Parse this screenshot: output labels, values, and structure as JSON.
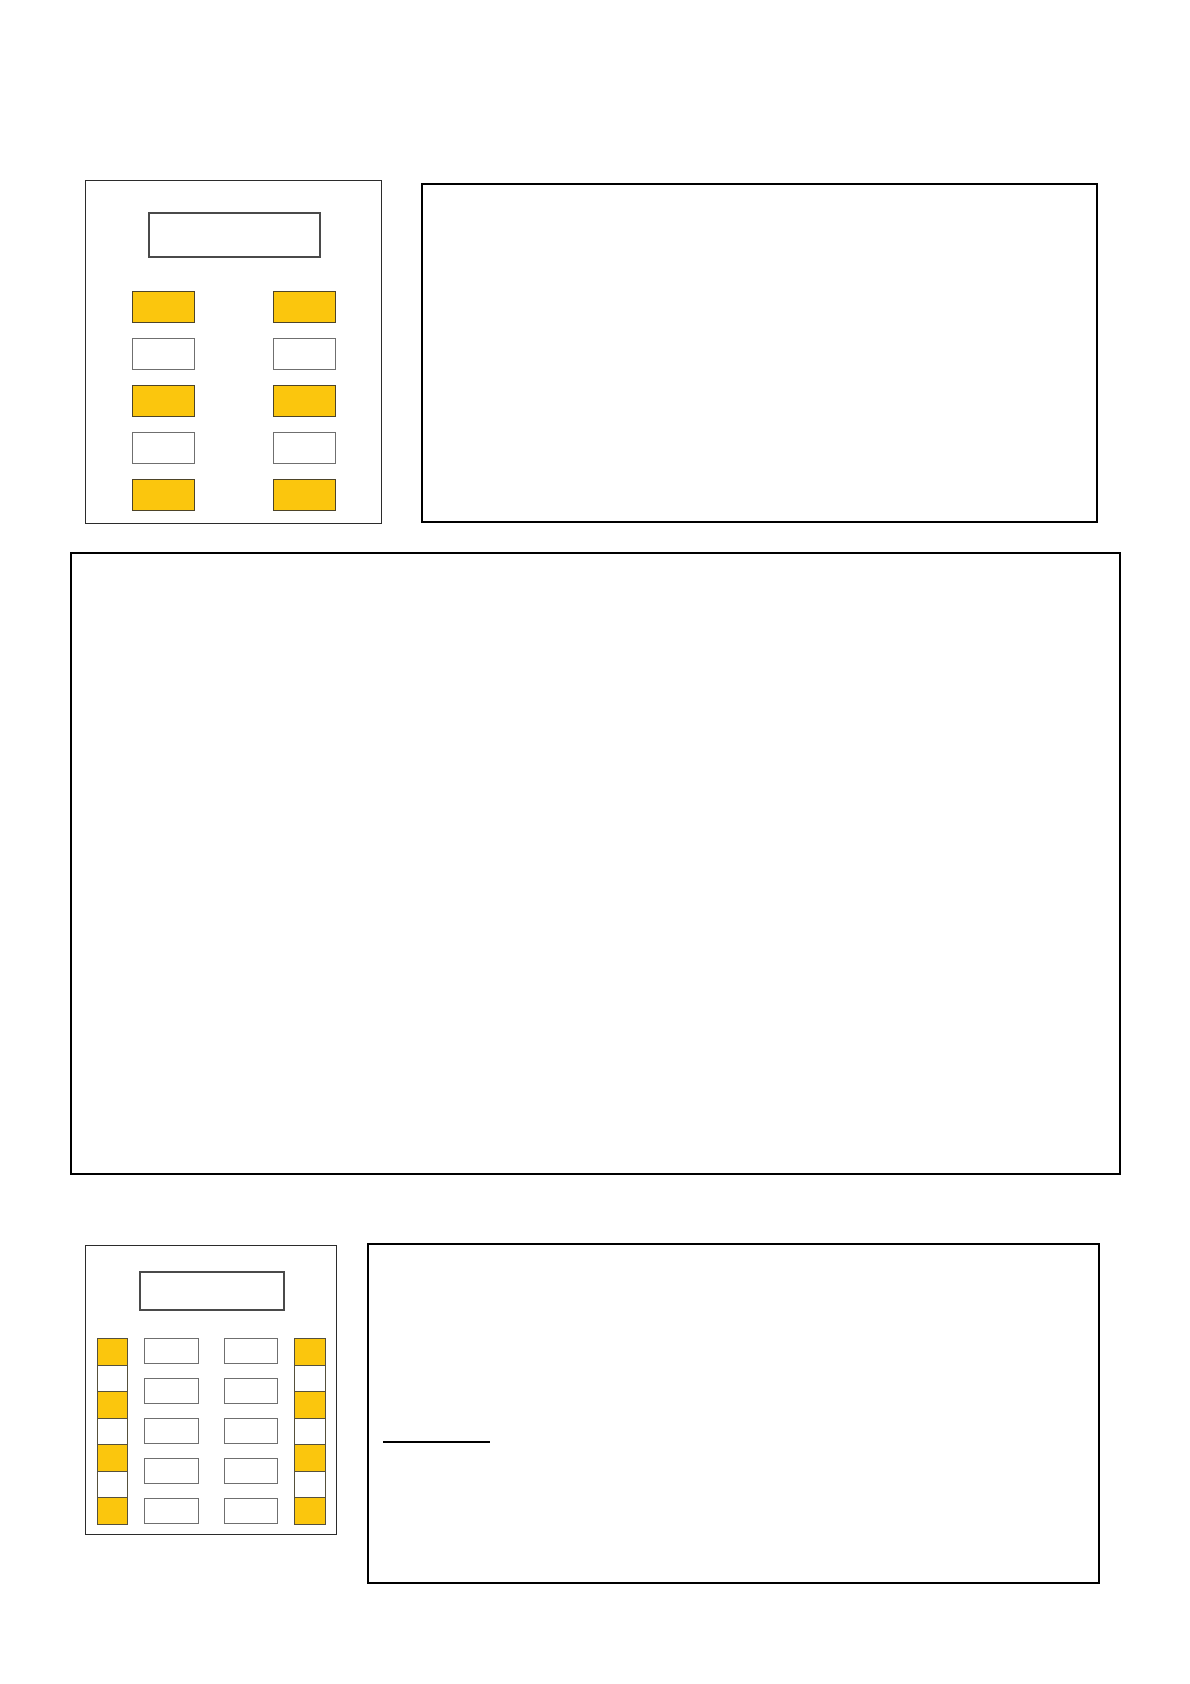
{
  "colors": {
    "page_background": "#ffffff",
    "panel_background": "#ffffff",
    "answer_box_border": "#000000",
    "device_panel_border": "#2b2b2b",
    "display_border": "#4a4a4a",
    "white_key_border": "#6f6f6f",
    "highlight_key_fill": "#FBC60D",
    "highlight_key_border": "#4d4428",
    "blank_line_color": "#000000"
  },
  "top_device_panel": {
    "display_value": "",
    "left_button_column": [
      "yellow",
      "white",
      "yellow",
      "white",
      "yellow"
    ],
    "right_button_column": [
      "yellow",
      "white",
      "yellow",
      "white",
      "yellow"
    ]
  },
  "top_right_answer_box": {
    "content": ""
  },
  "middle_answer_box": {
    "content": ""
  },
  "bottom_device_panel": {
    "display_value": "",
    "left_key_strip": [
      "yellow",
      "white",
      "yellow",
      "white",
      "yellow",
      "white",
      "yellow"
    ],
    "keypad_column_1": [
      "white",
      "white",
      "white",
      "white",
      "white"
    ],
    "keypad_column_2": [
      "white",
      "white",
      "white",
      "white",
      "white"
    ],
    "right_key_strip": [
      "yellow",
      "white",
      "yellow",
      "white",
      "yellow",
      "white",
      "yellow"
    ]
  },
  "bottom_right_answer_box": {
    "content": "",
    "has_blank_line": true
  }
}
